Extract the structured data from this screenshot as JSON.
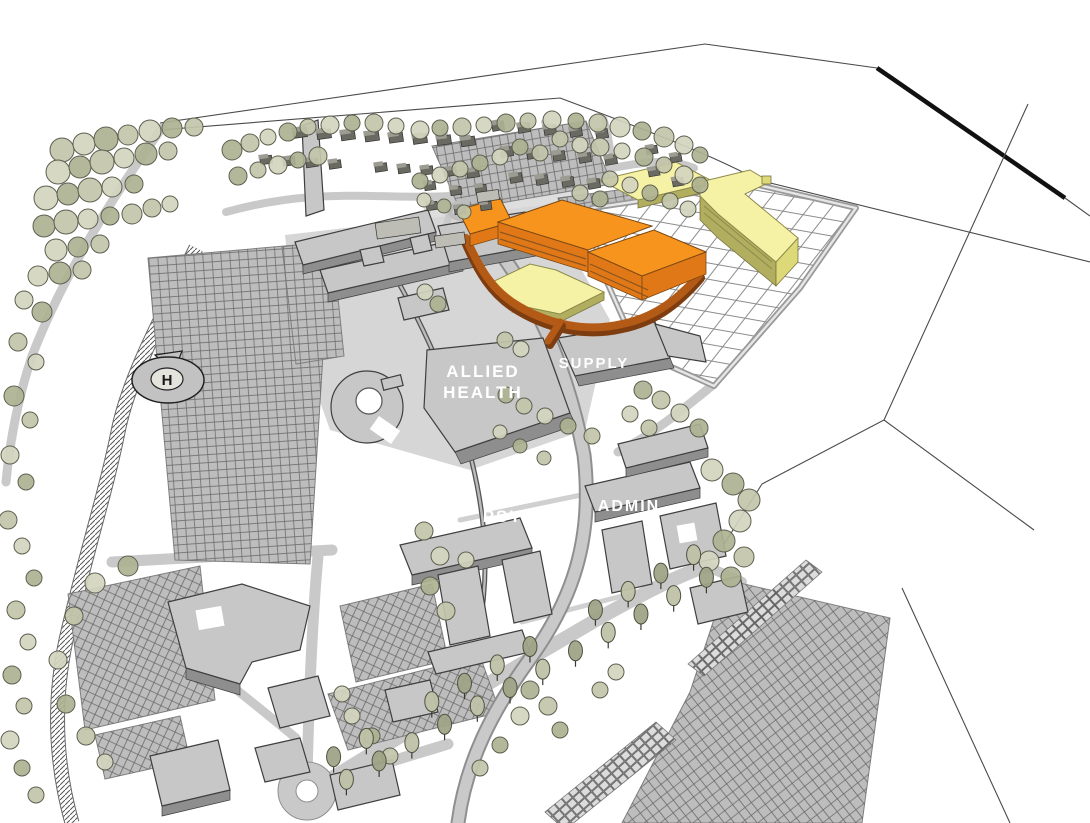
{
  "labels": {
    "allied_line1": "ALLIED",
    "allied_line2": "HEALTH",
    "supply": "SUPPLY",
    "psych": "PSYCH",
    "admin": "ADMIN",
    "helipad": "H"
  },
  "legend_colors": {
    "new_construction_top": "#F7941E",
    "new_construction_side": "#E07818",
    "new_construction_shadow": "#8A5420",
    "circulation_spine": "#B35B16",
    "circulation_spine_dark": "#7E3D10",
    "future_building_top": "#F5F2A6",
    "future_building_side": "#B2AE5F",
    "future_building_accent": "#DDD878",
    "existing_building_top": "#C7C7C7",
    "existing_building_side": "#8E8E8E",
    "road": "#C9C9C9",
    "parking": "#BDBDBD",
    "stall_line": "#5F5F5F",
    "tree_fill": "#C2C5A9",
    "tree_fill_light": "#D3D5BE",
    "tree_fill_dark": "#AEB293",
    "tree_stroke": "#5E6050",
    "house": "#6A6A62",
    "house_roof": "#9C9C92",
    "outline": "#3F3F3F",
    "boundary": "#111111",
    "grid_line": "#8C8C8C",
    "label_text": "#FFFFFF",
    "helipad_text": "#1A1A1A",
    "background": "#FFFFFF"
  }
}
